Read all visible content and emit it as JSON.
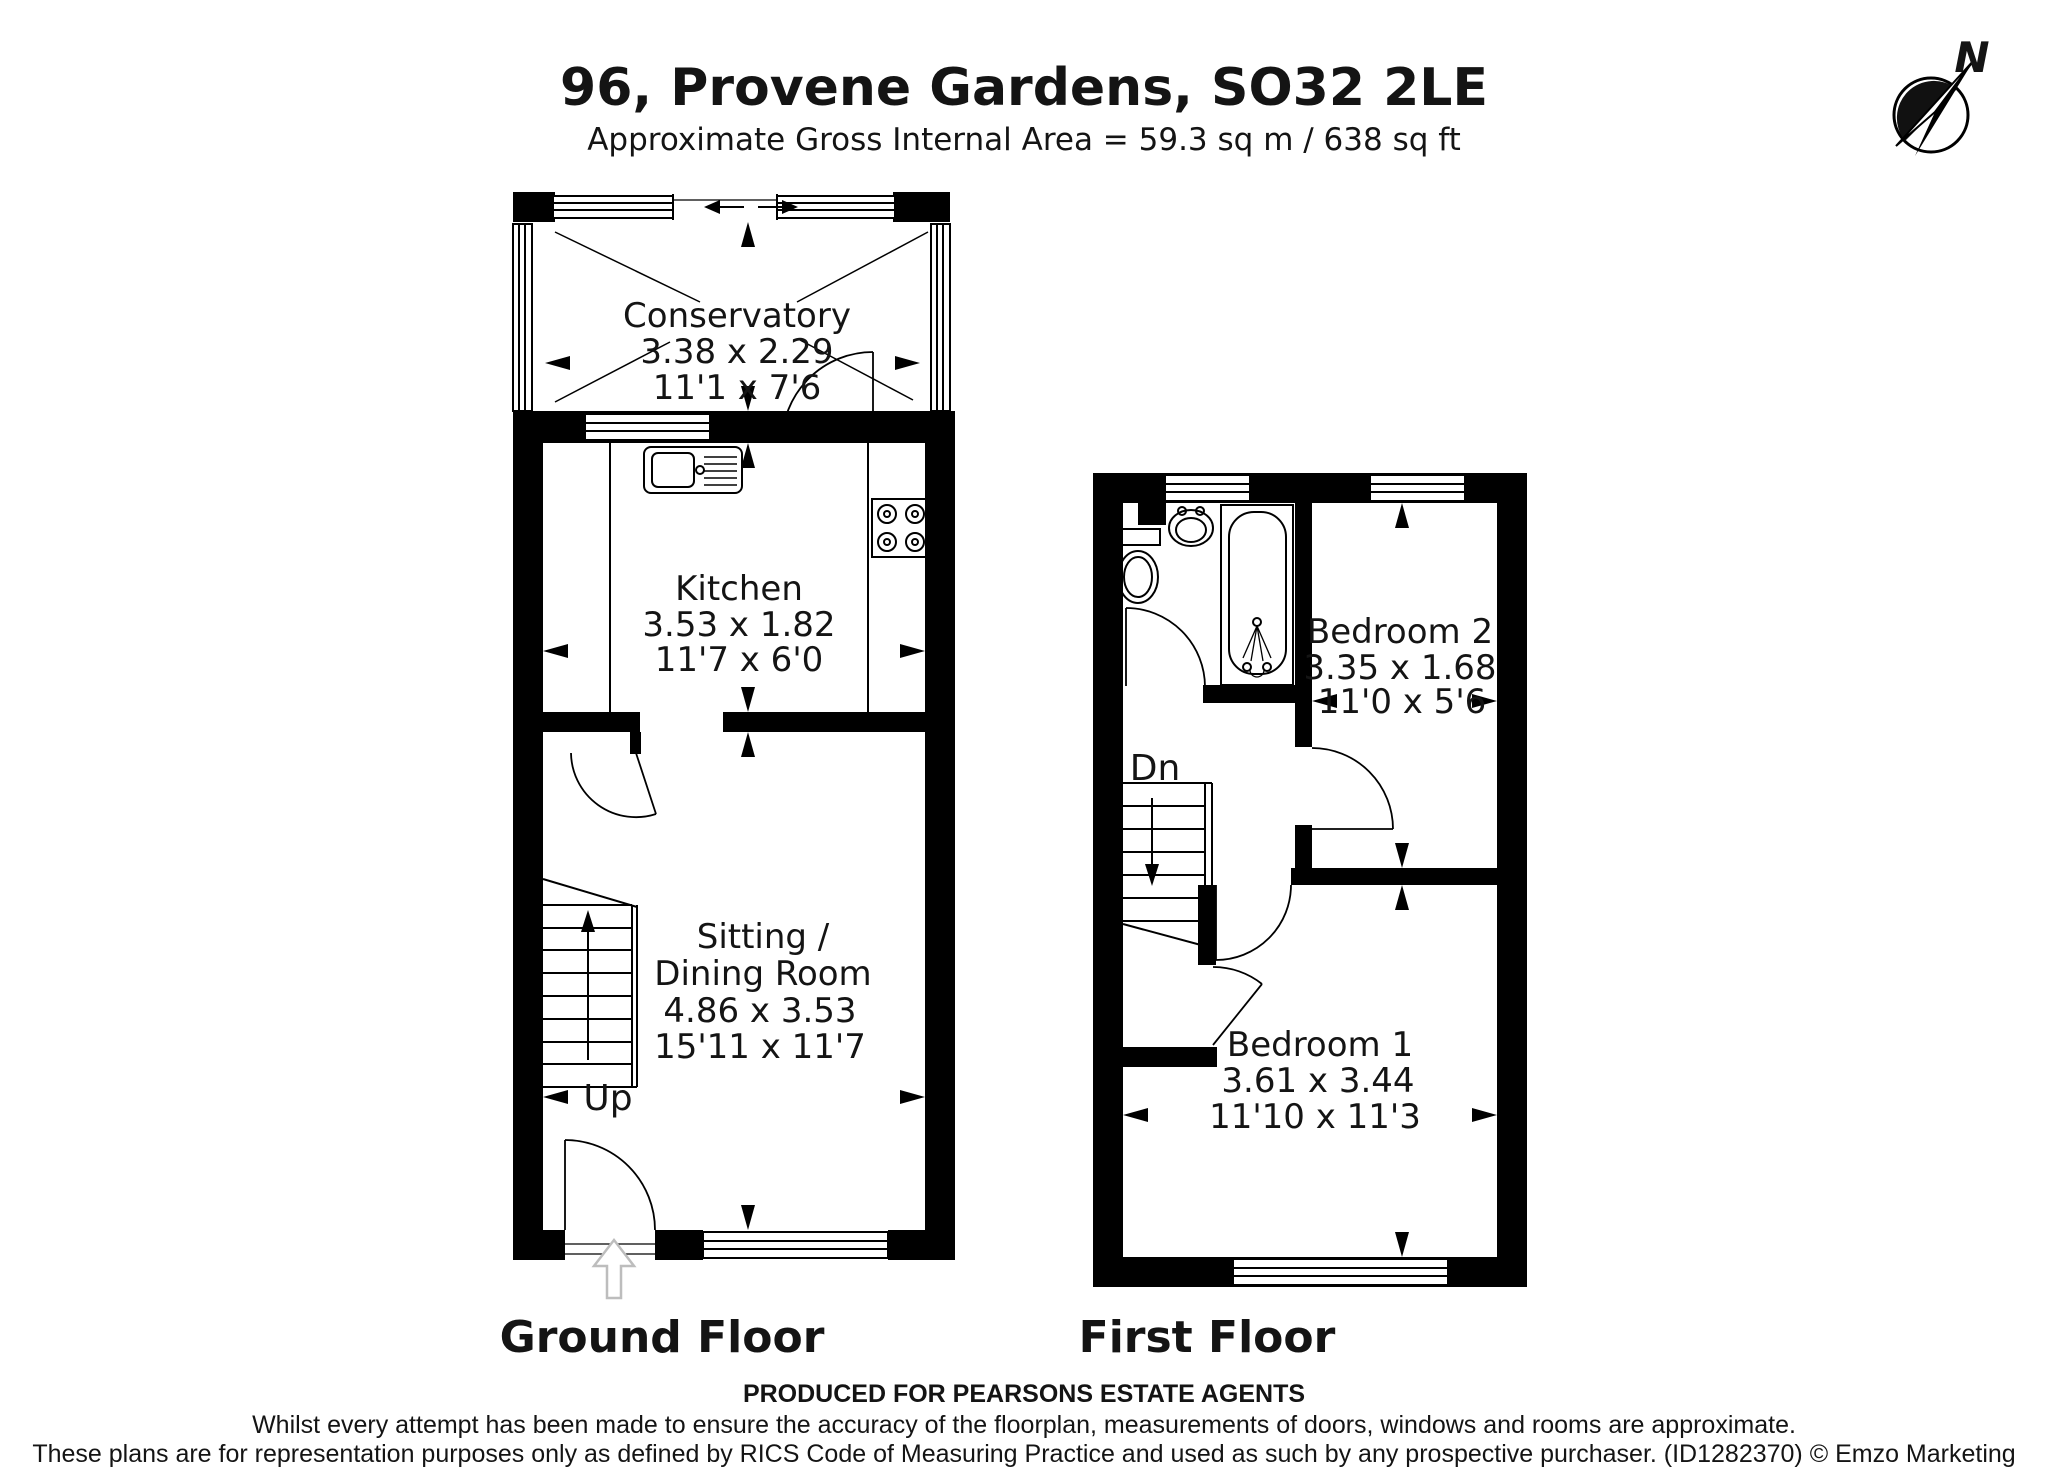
{
  "header": {
    "title": "96, Provene Gardens, SO32 2LE",
    "subtitle": "Approximate Gross Internal Area = 59.3 sq m / 638 sq ft"
  },
  "compass": {
    "north_label": "N"
  },
  "floors": {
    "ground": {
      "label": "Ground Floor",
      "stairs_direction": "Up",
      "rooms": {
        "conservatory": {
          "name": "Conservatory",
          "dims_m": "3.38 x 2.29",
          "dims_ft": "11'1 x 7'6"
        },
        "kitchen": {
          "name": "Kitchen",
          "dims_m": "3.53 x 1.82",
          "dims_ft": "11'7 x 6'0"
        },
        "sitting_dining": {
          "name_line1": "Sitting /",
          "name_line2": "Dining Room",
          "dims_m": "4.86 x 3.53",
          "dims_ft": "15'11 x 11'7"
        }
      }
    },
    "first": {
      "label": "First Floor",
      "stairs_direction": "Dn",
      "rooms": {
        "bedroom2": {
          "name": "Bedroom 2",
          "dims_m": "3.35 x 1.68",
          "dims_ft": "11'0 x 5'6"
        },
        "bedroom1": {
          "name": "Bedroom 1",
          "dims_m": "3.61 x 3.44",
          "dims_ft": "11'10 x 11'3"
        }
      }
    }
  },
  "footer": {
    "produced_for": "PRODUCED FOR PEARSONS ESTATE AGENTS",
    "disclaimer_line1": "Whilst every attempt has been made to ensure the accuracy of the floorplan, measurements of doors, windows and rooms are approximate.",
    "disclaimer_line2": "These plans are for representation purposes only as defined by RICS Code of Measuring Practice and used as such by any prospective purchaser. (ID1282370) © Emzo Marketing"
  },
  "colors": {
    "line": "#000000",
    "background": "#ffffff",
    "entrance_arrow": "#bdbdbd"
  }
}
